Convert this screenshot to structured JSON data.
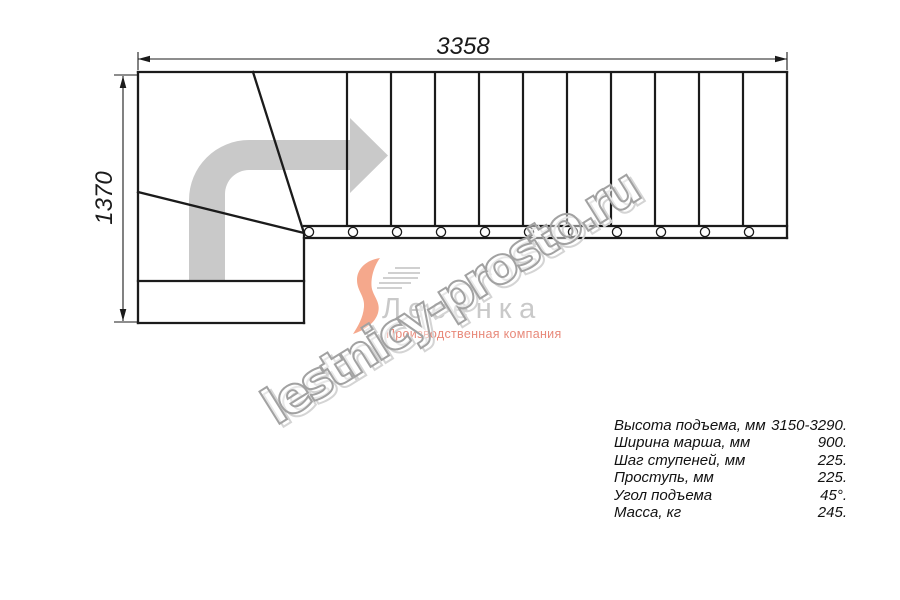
{
  "dimensions": {
    "width_mm": "3358",
    "height_mm": "1370"
  },
  "watermark": {
    "text": "lestnicy-prosto.ru"
  },
  "logo": {
    "name": "Лесенка",
    "tagline": "Производственная компания"
  },
  "specs": {
    "rows": [
      {
        "label": "Высота подъема, мм",
        "value": "3150-3290."
      },
      {
        "label": "Ширина марша, мм",
        "value": "900."
      },
      {
        "label": "Шаг ступеней, мм",
        "value": "225."
      },
      {
        "label": "Проступь, мм",
        "value": "225."
      },
      {
        "label": "Угол подъема",
        "value": "45°."
      },
      {
        "label": "Масса, кг",
        "value": "245."
      }
    ]
  },
  "colors": {
    "line": "#1b1b1b",
    "arrow_gray": "#c9c9c9",
    "watermark_gray": "#a2a2a2",
    "logo_gray": "#c9c9c9",
    "logo_salmon": "#f5a88c"
  }
}
